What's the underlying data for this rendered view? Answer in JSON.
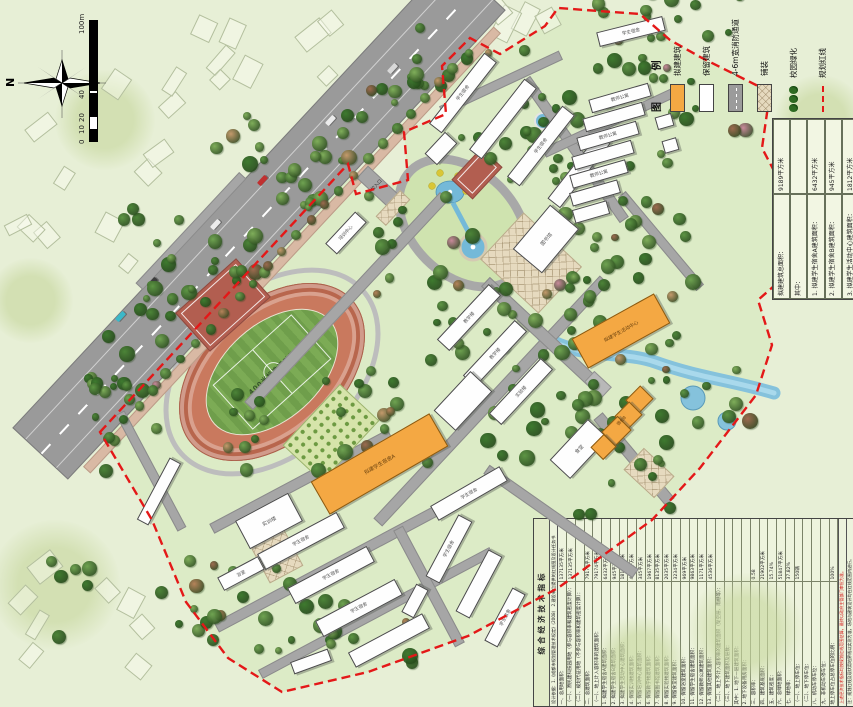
{
  "compass": {
    "north": "N"
  },
  "scale_bar": {
    "ticks": [
      "0",
      "10",
      "20",
      "40",
      "100m"
    ]
  },
  "legend": {
    "title": "图 例",
    "items": [
      {
        "label": "拟建建筑",
        "type": "proposed-building",
        "color": "#f4a843"
      },
      {
        "label": "保留建筑",
        "type": "retained-building",
        "color": "#ffffff"
      },
      {
        "label": "4-6m宽消防通道",
        "type": "fire-lane",
        "color": "#9b9b9b"
      },
      {
        "label": "铺装",
        "type": "paving",
        "color": "#e6dabf"
      },
      {
        "label": "校园绿化",
        "type": "campus-greening",
        "color": "#2e6b22"
      },
      {
        "label": "规划红线",
        "type": "planning-red-line",
        "color": "#e41818"
      }
    ]
  },
  "area_table": {
    "rows": [
      {
        "label": "拟建建筑总面积：",
        "value": "9189平方米"
      },
      {
        "label": "其中：",
        "value": ""
      },
      {
        "label": "1. 拟建学生宿舍A建筑面积：",
        "value": "6432平方米"
      },
      {
        "label": "2. 拟建学生宿舍B建筑面积：",
        "value": "945平方米"
      },
      {
        "label": "3. 拟建学生活动中心建筑面积：",
        "value": "1812平方米"
      }
    ]
  },
  "indicator_table": {
    "title": "综合经济技术指标",
    "basis": "设计依据：1.《成都市规划管理技术规定》(2008)　2.建设单位提供的红线图及设计任务书",
    "rows": [
      [
        "一、总用地面积：",
        "137135平方米"
      ],
      [
        "（一）、原民建科技园用地（参与容积率和建筑密度计算）：",
        "137135平方米"
      ],
      [
        "（二）、规划代征用地（不参与容积率和建筑密度计算）：",
        ""
      ],
      [
        "二、总建筑面积：",
        "79174平方米"
      ],
      [
        "（一）、地上计入容积率的建筑面积：",
        "79174平方米"
      ],
      [
        "1. 拟建学生宿舍A建筑面积：",
        "6432平方米"
      ],
      [
        "2. 拟建学生宿舍B建筑面积：",
        "945平方米"
      ],
      [
        "3. 拟建学生活动中心建筑面积：",
        "1812平方米"
      ],
      [
        "4. 保留实训楼建筑面积：",
        "4052平方米"
      ],
      [
        "5. 保留培训中心建筑面积：",
        "345平方米"
      ],
      [
        "6. 保留教学楼建筑面积：",
        "1967平方米"
      ],
      [
        "7. 保留图书馆建筑面积：",
        "8135平方米"
      ],
      [
        "8. 保留实验楼建筑面积：",
        "2035平方米"
      ],
      [
        "9. 保留食堂建筑面积：",
        "3234平方米"
      ],
      [
        "10. 保留浴室建筑面积：",
        "969平方米"
      ],
      [
        "11. 保留学生宿舍建筑面积：",
        "9863平方米"
      ],
      [
        "12. 保留教师公寓建筑面积：",
        "1171平方米"
      ],
      [
        "13. 保留其他建筑面积：",
        "4536平方米"
      ],
      [
        "（二）、地上不计入容积率的建筑面积（架空层、雨棚等）：",
        ""
      ],
      [
        "（三）、地下建筑面积及层数：",
        ""
      ],
      [
        "其中：1. 地下一层建筑面积：",
        ""
      ],
      [
        "2. 地下设备用房面积：",
        ""
      ],
      [
        "三、容积率：",
        "0.58"
      ],
      [
        "四、建筑基底面积：",
        "21902平方米"
      ],
      [
        "五、建筑密度：",
        "15.74%"
      ],
      [
        "六、总绿地面积：",
        "51847平方米"
      ],
      [
        "七、绿地率：",
        "37.82%"
      ],
      [
        "（一）、地上停车位：",
        "150辆"
      ],
      [
        "（二）、地下停车位：",
        ""
      ],
      [
        "八、机动车停车位：",
        ""
      ],
      [
        "九、非机动车停车位：",
        ""
      ],
      [
        "地上停车位占总停车位的比例：",
        "100%"
      ]
    ],
    "note_red": "上述经济技术指标均按规划红线范围估算，最终以政府主管部门审批为准。",
    "note": "注：规划红线及现状用地界线以实测为准，场地与建筑设计均在红线范围内进行。"
  },
  "map_labels": {
    "track": "400米标准运动场",
    "entrance": "学校入口",
    "dorm_a": "拟建学生宿舍A",
    "dorm_b": "宿舍B",
    "activity_center": "拟建学生活动中心",
    "student_dorm": "学生宿舍",
    "teacher_apartment": "教师公寓",
    "teaching_building": "教学楼",
    "training_building": "实训楼",
    "lab_building": "实验楼",
    "library": "图书馆",
    "canteen": "食堂",
    "bathhouse": "浴室",
    "training_center": "培训中心"
  }
}
